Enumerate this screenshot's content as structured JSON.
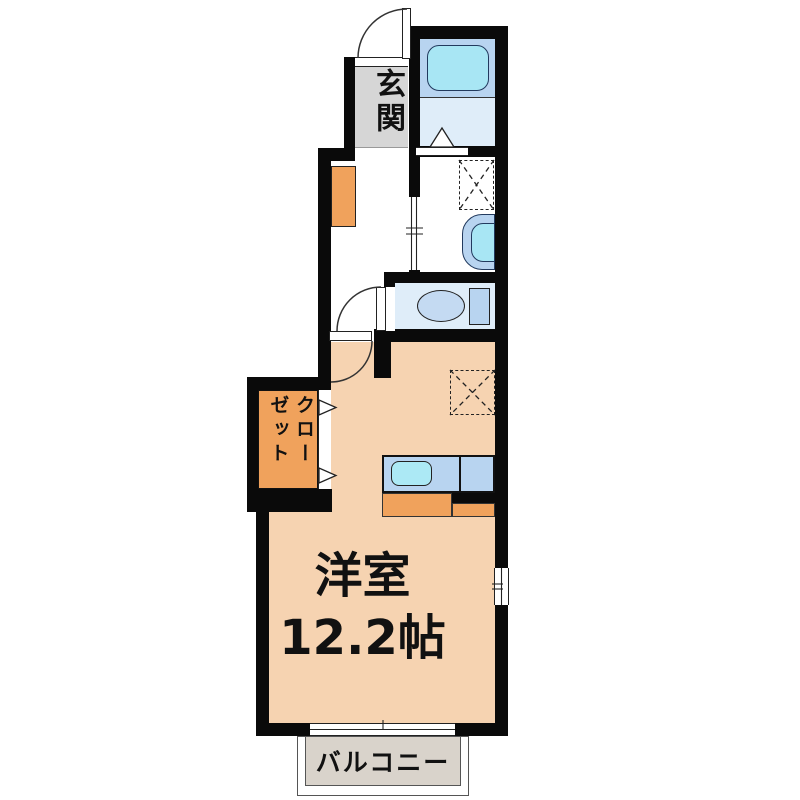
{
  "rooms": {
    "entrance": {
      "label": "玄関"
    },
    "main_room": {
      "label": "洋室",
      "size": "12.2帖"
    },
    "closet": {
      "label_right_column": "クロー",
      "label_left_column": "ゼット"
    },
    "balcony": {
      "label": "バルコニー"
    }
  },
  "colors": {
    "wall": "#0a0a0a",
    "room-floor": "#f6d3b1",
    "accent-orange": "#f0a25c",
    "entrance-gray": "#d6d6d6",
    "zone-blue": "#b8d4f0",
    "floor-blue": "#dfedf9",
    "fixture-cyan": "#a8e6f4",
    "toilet-blue": "#c4daf2",
    "sink-cyan": "#ace9f5",
    "balcony-gray": "#d9d3cb"
  }
}
